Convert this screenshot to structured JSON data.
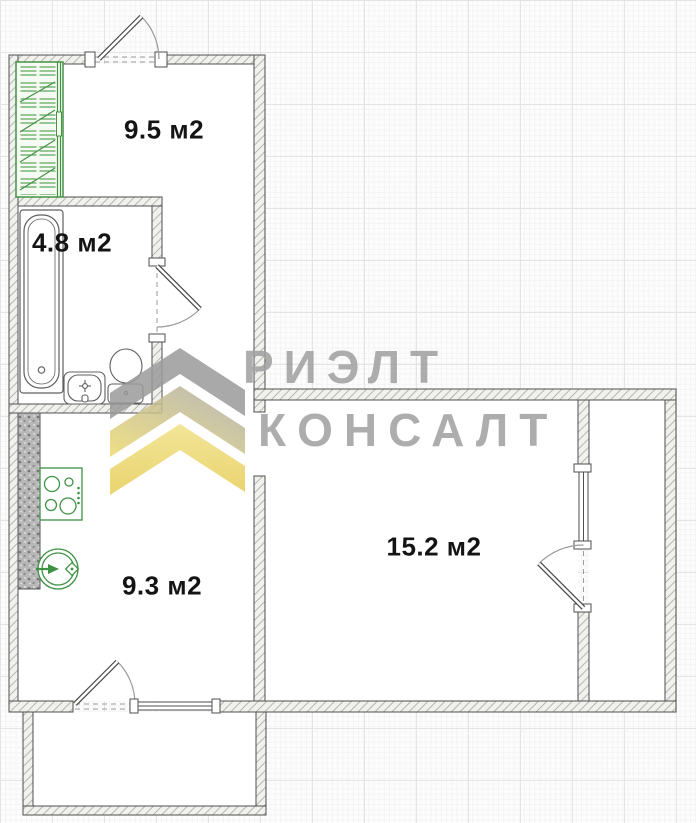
{
  "watermark": {
    "line1": "РИЭЛТ",
    "line2": "КОНСАЛТ"
  },
  "rooms": [
    {
      "name": "hallway",
      "area_label": "9.5 м2"
    },
    {
      "name": "bathroom",
      "area_label": "4.8 м2"
    },
    {
      "name": "kitchen",
      "area_label": "9.3 м2"
    },
    {
      "name": "living-room",
      "area_label": "15.2 м2"
    }
  ],
  "colors": {
    "wall_hatch": "#b5b5b2",
    "wall_outline": "#4f4f4f",
    "fixture_green": "#3f9244",
    "watermark_gray": "#a2a2a2",
    "watermark_yellow": "#ecd76d",
    "label_black": "#141414"
  }
}
